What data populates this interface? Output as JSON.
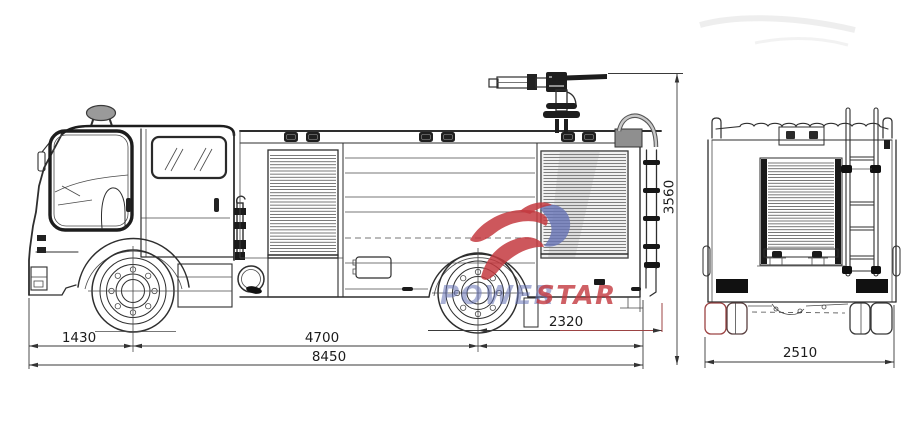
{
  "drawing": {
    "subject": "fire-truck-two-view-dimensional-drawing",
    "views": [
      "side",
      "rear"
    ]
  },
  "dimensions": {
    "front_overhang": "1430",
    "wheelbase": "4700",
    "rear_overhang": "2320",
    "overall_length": "8450",
    "overall_height": "3560",
    "overall_width": "2510"
  },
  "watermark": {
    "part1": "POWER",
    "part2": "STAR"
  },
  "colors": {
    "line": "#2e2e2e",
    "dim_line": "#3a3a3a",
    "red_line": "#9c4343",
    "watermark_blue": "#6673b5",
    "watermark_red": "#c4393f",
    "beacon_gray": "#9a9a9a",
    "handrail_gray": "#c9c9c9"
  }
}
